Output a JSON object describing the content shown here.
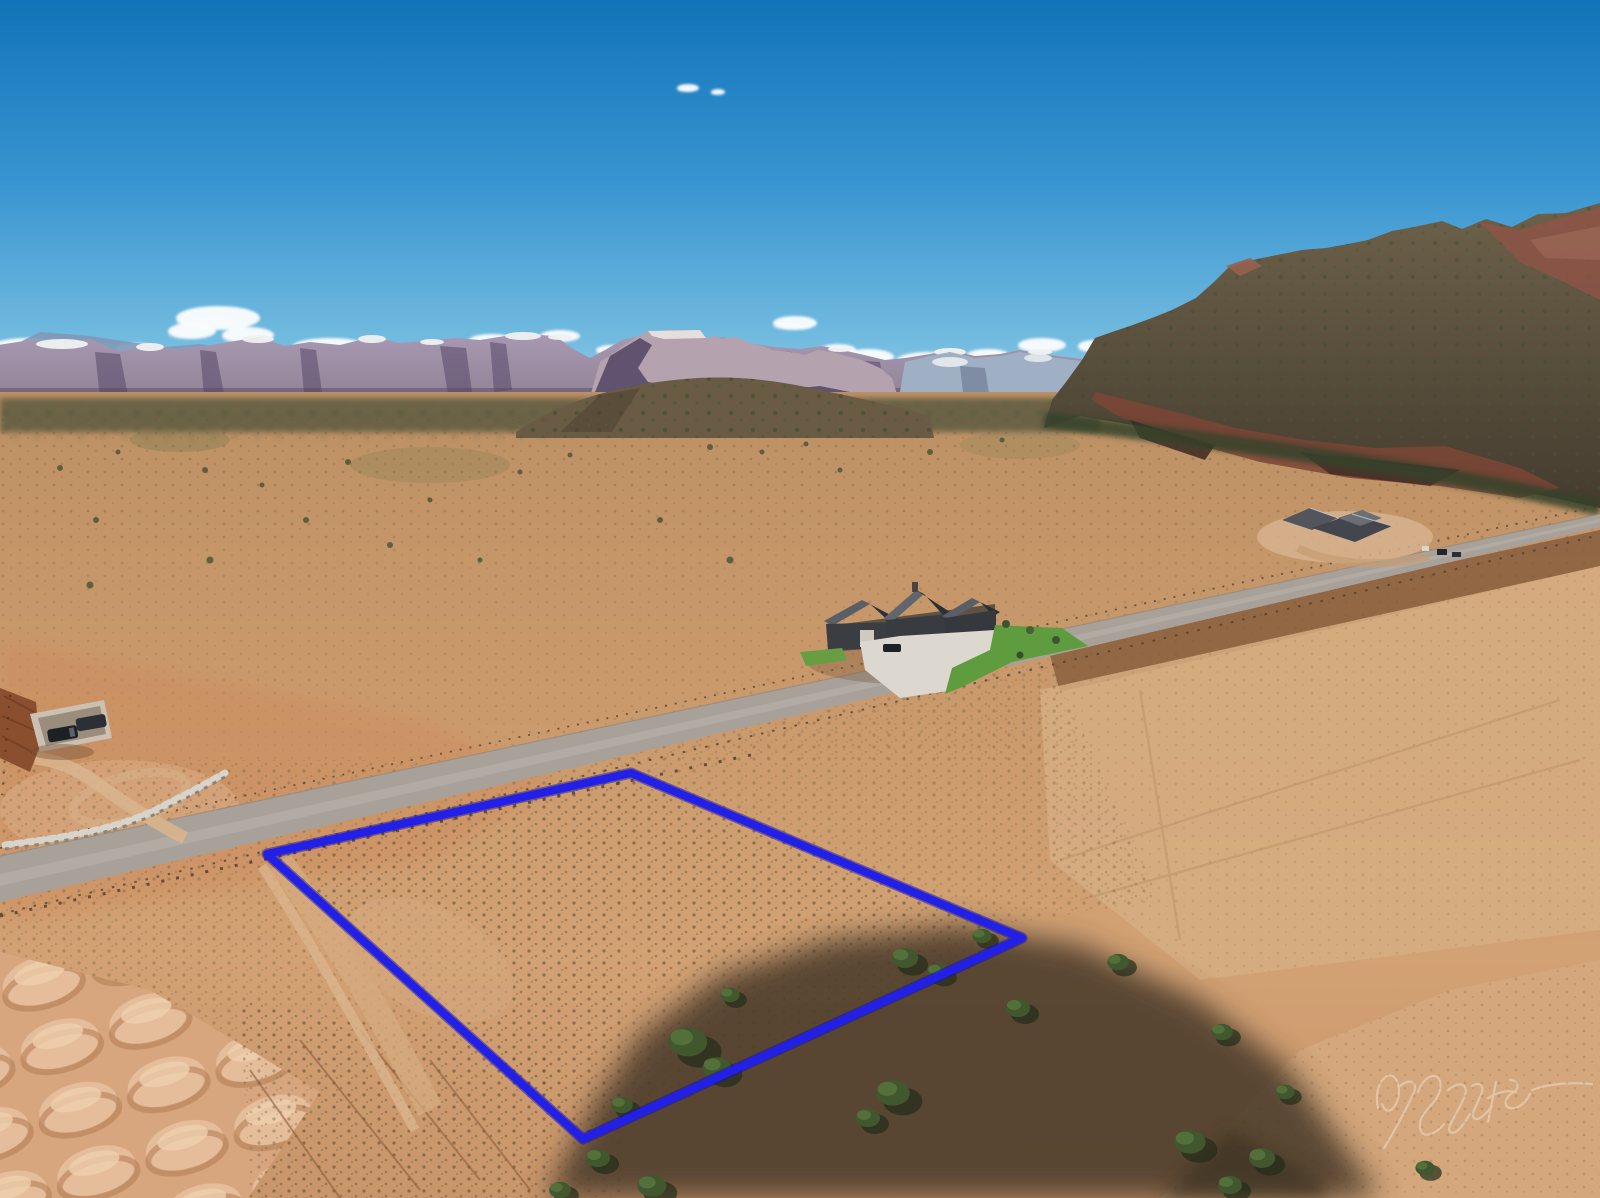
{
  "image": {
    "kind": "aerial drone photograph",
    "description": "Aerial real-estate photo of a vacant desert lot outlined in blue, with a paved road, ranch house, distant Zion-style cliffs and a red mesa under a blue sky",
    "width": 1600,
    "height": 1198
  },
  "watermark": {
    "kind": "handwritten photographer signature (cursive, semi-transparent)",
    "color": "#ffffff",
    "opacity": "0.33"
  },
  "palette": {
    "sky_top": "#1173b9",
    "sky_mid": "#3a96d1",
    "sky_horizon": "#a9d9ec",
    "cliff_mauve": "#a295ad",
    "cliff_shadow": "#57496a",
    "snow": "#f0f1f2",
    "mesa_rock": "#665a45",
    "mesa_red": "#7c4536",
    "valley_tan": "#c4976a",
    "foreground_tan": "#cf9d6f",
    "road_gray": "#a7a19a",
    "outline_blue": "#2220e6",
    "lawn_green": "#5f9c40",
    "tree_green": "#41572e",
    "shadow_umber": "#4a3b2b"
  },
  "property_outline": {
    "color": "#2220e6",
    "corners": "631,773 1022,938 583,1139 267,854",
    "stroke_width": "8"
  },
  "scene": {
    "clouds": [
      [
        28,
        346,
        36,
        8
      ],
      [
        82,
        351,
        28,
        7
      ],
      [
        135,
        349,
        20,
        6
      ],
      [
        218,
        318,
        42,
        12
      ],
      [
        192,
        331,
        24,
        8
      ],
      [
        248,
        335,
        26,
        8
      ],
      [
        330,
        347,
        38,
        9
      ],
      [
        430,
        351,
        32,
        8
      ],
      [
        492,
        341,
        24,
        7
      ],
      [
        560,
        336,
        20,
        6
      ],
      [
        612,
        350,
        16,
        5
      ],
      [
        795,
        323,
        22,
        7
      ],
      [
        838,
        350,
        18,
        6
      ],
      [
        868,
        357,
        26,
        8
      ],
      [
        928,
        361,
        32,
        9
      ],
      [
        988,
        356,
        22,
        7
      ],
      [
        1042,
        345,
        24,
        7
      ],
      [
        1094,
        346,
        16,
        6
      ],
      [
        688,
        88,
        11,
        4
      ],
      [
        718,
        92,
        7,
        3
      ]
    ],
    "trees": [
      [
        688,
        1042,
        1.6
      ],
      [
        717,
        1068,
        1.2
      ],
      [
        905,
        958,
        1.1
      ],
      [
        938,
        972,
        0.9
      ],
      [
        893,
        1093,
        1.4
      ],
      [
        868,
        1118,
        1.0
      ],
      [
        1018,
        1008,
        1.0
      ],
      [
        1190,
        1142,
        1.3
      ],
      [
        1262,
        1158,
        1.1
      ],
      [
        598,
        1158,
        1.0
      ],
      [
        652,
        1186,
        1.2
      ],
      [
        1222,
        1032,
        0.9
      ],
      [
        1425,
        1168,
        0.8
      ],
      [
        982,
        936,
        0.8
      ],
      [
        1118,
        962,
        0.9
      ],
      [
        730,
        995,
        0.8
      ],
      [
        622,
        1105,
        0.9
      ],
      [
        1285,
        1092,
        0.8
      ],
      [
        560,
        1190,
        0.9
      ],
      [
        1230,
        1185,
        1.0
      ]
    ],
    "distant_shrubs": [
      [
        60,
        468,
        3
      ],
      [
        118,
        452,
        2.5
      ],
      [
        205,
        470,
        3
      ],
      [
        262,
        485,
        2.5
      ],
      [
        348,
        462,
        3
      ],
      [
        306,
        520,
        3
      ],
      [
        96,
        520,
        3
      ],
      [
        430,
        500,
        2.5
      ],
      [
        710,
        447,
        3
      ],
      [
        762,
        452,
        2.5
      ],
      [
        806,
        444,
        2.5
      ],
      [
        930,
        452,
        3
      ],
      [
        1002,
        440,
        2.5
      ],
      [
        520,
        472,
        2.5
      ],
      [
        570,
        455,
        2.5
      ],
      [
        660,
        520,
        3
      ],
      [
        730,
        560,
        3.5
      ],
      [
        210,
        560,
        3.5
      ],
      [
        90,
        585,
        3.5
      ],
      [
        390,
        545,
        3
      ],
      [
        480,
        560,
        2.5
      ],
      [
        840,
        470,
        2.5
      ]
    ]
  }
}
